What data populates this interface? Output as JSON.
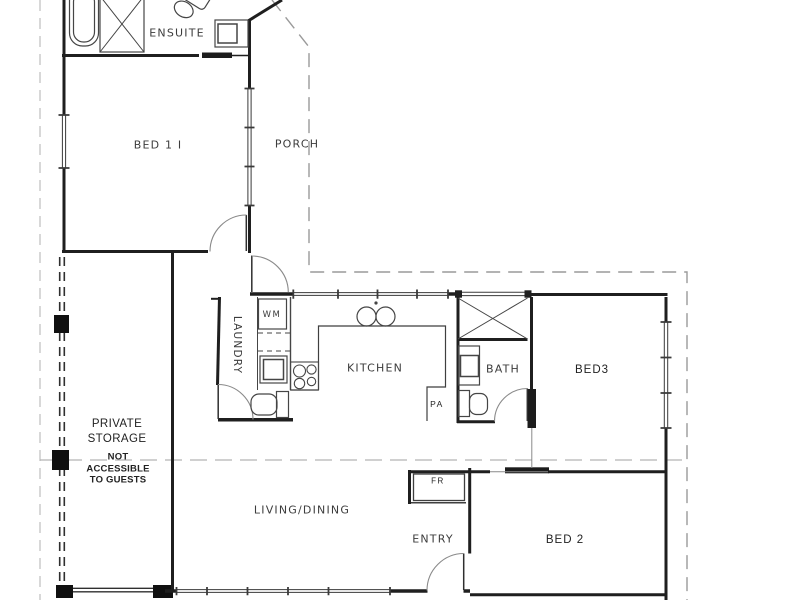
{
  "title": "Floor plan",
  "labels": {
    "ensuite": "ENSUITE",
    "bed1": "BED 1 I",
    "porch": "PORCH",
    "laundry": "LAUNDRY",
    "wm": "WM",
    "kitchen": "KITCHEN",
    "pa": "PA",
    "bath": "BATH",
    "bed3": "BED3",
    "living": "LIVING/DINING",
    "entry": "ENTRY",
    "bed2": "BED 2",
    "fr": "FR",
    "storage_line1": "PRIVATE",
    "storage_line2": "STORAGE",
    "note_line1": "NOT",
    "note_line2": "ACCESSIBLE",
    "note_line3": "TO GUESTS"
  },
  "colors": {
    "wall": "#1f1f1f",
    "fixture": "#454545",
    "door_arc": "#8a8a8a",
    "boundary_dash": "#9a9a9a",
    "light_dash": "#c4c4c4",
    "text": "#3c3c3c"
  }
}
